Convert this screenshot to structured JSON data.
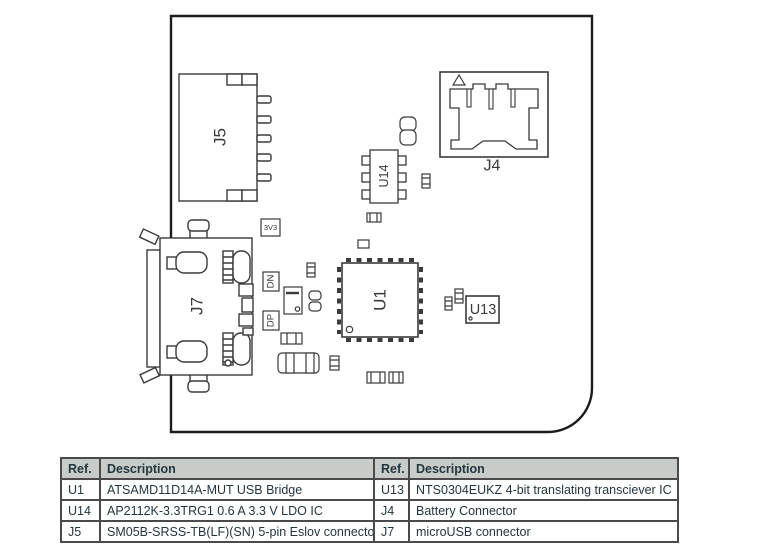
{
  "board": {
    "labels": {
      "j5": "J5",
      "j7": "J7",
      "u14": "U14",
      "u1": "U1",
      "u13": "U13",
      "j4": "J4",
      "v33": "3V3",
      "dn": "DN",
      "dp": "DP"
    }
  },
  "table": {
    "columns": [
      "Ref.",
      "Description",
      "Ref.",
      "Description"
    ],
    "rows": [
      [
        "U1",
        "ATSAMD11D14A-MUT USB Bridge",
        "U13",
        "NTS0304EUKZ 4-bit translating transciever IC"
      ],
      [
        "U14",
        "AP2112K-3.3TRG1 0.6 A 3.3 V LDO IC",
        "J4",
        "Battery Connector"
      ],
      [
        "J5",
        "SM05B-SRSS-TB(LF)(SN) 5-pin Eslov connector",
        "J7",
        "microUSB connector"
      ]
    ]
  },
  "colors": {
    "line_art": "#3a3a3a",
    "board_outline": "#1c1c1c",
    "table_border": "#4a4a4a",
    "table_header_bg": "#c8ccc8",
    "table_text": "#233640"
  }
}
